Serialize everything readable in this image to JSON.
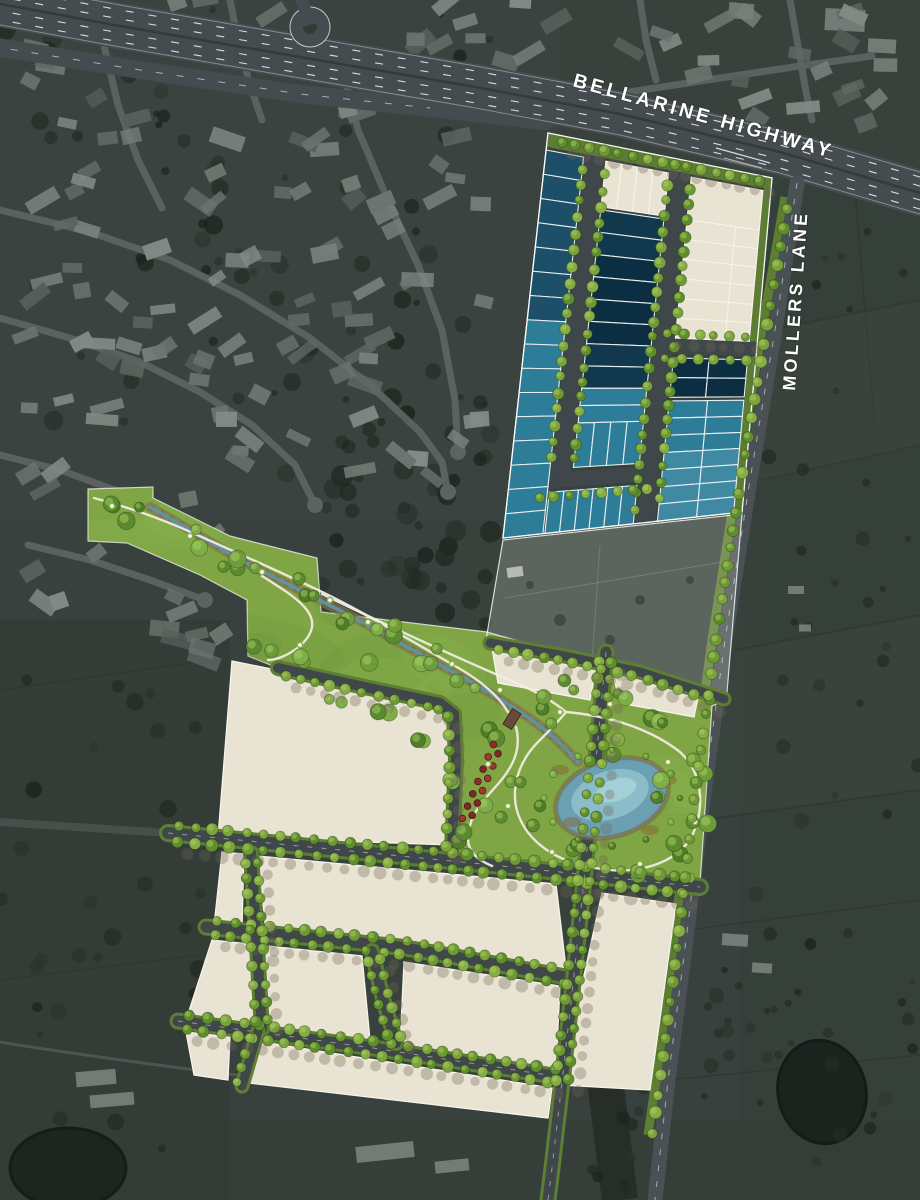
{
  "map": {
    "title": "Aerial estate masterplan",
    "labels": {
      "highway": "BELLARINE HIGHWAY",
      "lane": "MOLLERS LANE"
    },
    "colors": {
      "aerial_dark": "#38413d",
      "road_gray": "#3f474b",
      "highway_gray": "#454c4f",
      "lane_gray": "#4a5154",
      "lot_cream": "#e9e3d3",
      "lot_cream_line": "#f7f4ea",
      "lot_teal": "#2e7d98",
      "lot_teal_light": "#3f8aa2",
      "lot_navy": "#1d5068",
      "lot_navy_dark": "#12384d",
      "lot_navy_deepest": "#0c2e42",
      "park_green": "#7fa544",
      "verge_green": "#5c7d33",
      "street_tree_green": "#6f9a35",
      "pond_blue": "#6aa0b2",
      "pond_blue_light": "#8fc2cd",
      "creek_blue": "#5e93a8",
      "creek_bank_brown": "#86744c",
      "feature_tree_red": "#8f2d2c",
      "path_white": "#f2eee4",
      "label_white": "#ffffff"
    }
  }
}
